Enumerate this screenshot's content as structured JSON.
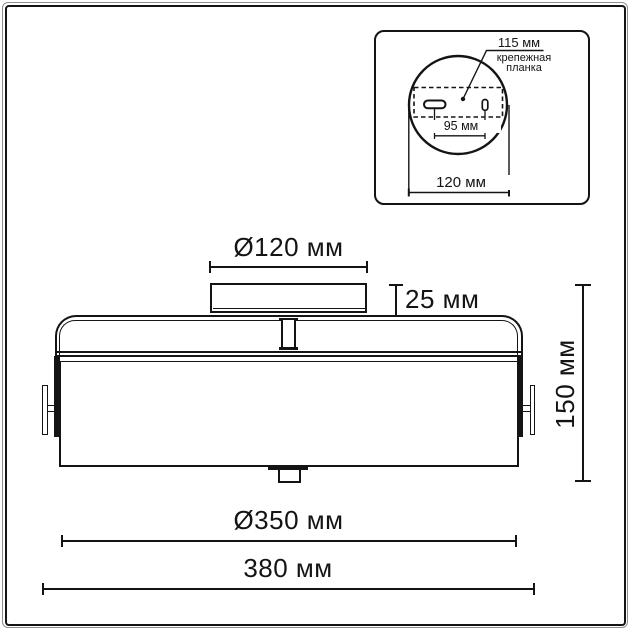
{
  "main": {
    "dims": {
      "canopy_diameter": "Ø120 мм",
      "canopy_height": "25 мм",
      "total_height": "150 мм",
      "shade_diameter": "Ø350 мм",
      "total_width": "380 мм"
    }
  },
  "inset": {
    "labels": {
      "offset_115": "115 мм",
      "plate_line1": "крепежная",
      "plate_line2": "планка",
      "dim_95": "95 мм",
      "dim_120": "120 мм"
    }
  },
  "colors": {
    "line": "#141414",
    "frame_gray": "#8f8f8f",
    "background": "#ffffff"
  }
}
